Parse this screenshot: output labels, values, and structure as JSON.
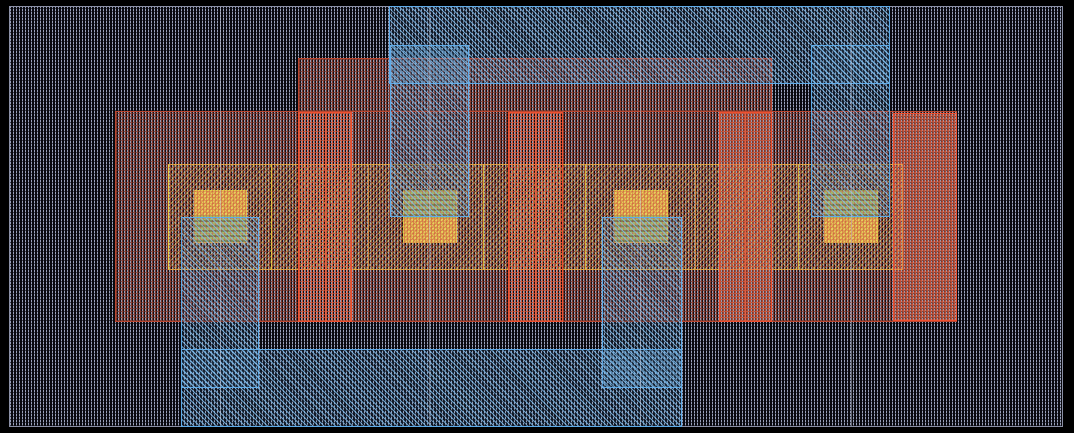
{
  "canvas": {
    "width": 1074,
    "height": 433,
    "background_color": "#000000",
    "viewport": {
      "x": 9,
      "y": 6,
      "w": 1054,
      "h": 421,
      "border_color": "#8b90a6",
      "fill_color": "#08080e",
      "substrate_hatch_color": "#99a1ba"
    }
  },
  "colors": {
    "metal_outline": "#5fabe8",
    "metal_hatch": "#7fc0f0",
    "poly_outline": "#b9462f",
    "poly_hatch": "#d05a41",
    "gate_outline": "#ee4e2e",
    "active_outline": "#efe13e",
    "active_hatch": "#eadc55",
    "contact_fill": "#e9dc60",
    "contact_metal_overlap_fill": "#c6da72",
    "grid_line": "#c3c8da"
  },
  "grid": {
    "x_positions": [
      220,
      429,
      640,
      851
    ],
    "y0": 7,
    "y1": 426
  },
  "layers": [
    {
      "css": "active",
      "name": "active-region",
      "interactable": true,
      "rects": [
        {
          "n": "active-band",
          "x": 168,
          "y": 164,
          "w": 735,
          "h": 106
        }
      ],
      "vlines": {
        "xs": [
          271,
          368,
          483,
          585,
          695,
          798
        ],
        "y0": 165,
        "y1": 269,
        "css": "ydiv",
        "name": "active-divider"
      }
    },
    {
      "css": "contact",
      "name": "contact-square",
      "interactable": true,
      "rects": [
        {
          "n": "contact-1",
          "x": 194,
          "y": 190,
          "w": 53,
          "h": 53,
          "metal": "bottom"
        },
        {
          "n": "contact-2",
          "x": 403,
          "y": 190,
          "w": 54,
          "h": 53,
          "metal": "top"
        },
        {
          "n": "contact-3",
          "x": 614,
          "y": 190,
          "w": 54,
          "h": 53,
          "metal": "bottom"
        },
        {
          "n": "contact-4",
          "x": 824,
          "y": 190,
          "w": 54,
          "h": 53,
          "metal": "top"
        }
      ]
    },
    {
      "css": "poly",
      "name": "poly-region",
      "interactable": true,
      "rects": [
        {
          "n": "poly-strap-top",
          "x": 298,
          "y": 58,
          "w": 474,
          "h": 54
        },
        {
          "n": "well-region",
          "x": 115,
          "y": 111,
          "w": 842,
          "h": 211
        }
      ]
    },
    {
      "css": "gate",
      "name": "gate-strip",
      "interactable": true,
      "rects": [
        {
          "n": "gate-1",
          "x": 298,
          "y": 112,
          "w": 54,
          "h": 210
        },
        {
          "n": "gate-2",
          "x": 508,
          "y": 112,
          "w": 55,
          "h": 210
        },
        {
          "n": "gate-3",
          "x": 719,
          "y": 112,
          "w": 53,
          "h": 210
        },
        {
          "n": "right-select-region",
          "x": 893,
          "y": 113,
          "w": 64,
          "h": 208
        }
      ],
      "vlines": {
        "xs": [
          325,
          535,
          745
        ],
        "y0": 112,
        "y1": 322,
        "css": "gdiv",
        "name": "gate-center-edge"
      }
    },
    {
      "css": "metal",
      "name": "metal-region",
      "interactable": true,
      "rects": [
        {
          "n": "metal-top-rail",
          "x": 389,
          "y": 6,
          "w": 501,
          "h": 78
        },
        {
          "n": "metal-stub-top-left",
          "x": 390,
          "y": 45,
          "w": 79,
          "h": 172
        },
        {
          "n": "metal-stub-top-right",
          "x": 811,
          "y": 45,
          "w": 79,
          "h": 172
        },
        {
          "n": "metal-stub-bottom-left",
          "x": 181,
          "y": 217,
          "w": 78,
          "h": 171
        },
        {
          "n": "metal-stub-bottom-mid",
          "x": 602,
          "y": 217,
          "w": 80,
          "h": 171
        },
        {
          "n": "metal-bottom-rail",
          "x": 181,
          "y": 349,
          "w": 501,
          "h": 78
        }
      ]
    }
  ]
}
